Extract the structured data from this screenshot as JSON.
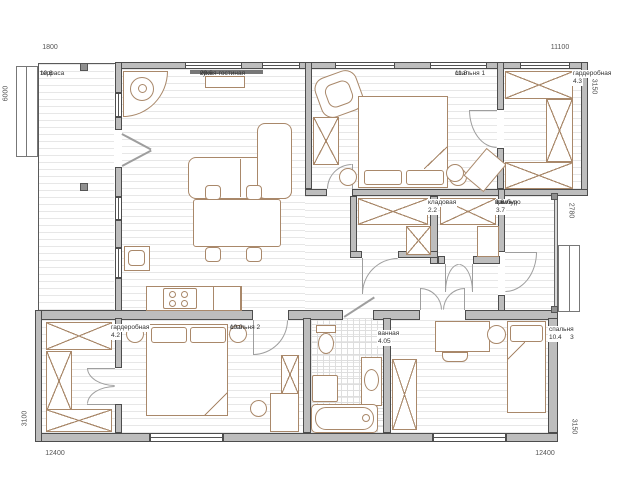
{
  "plan": {
    "title": "floor-plan",
    "rooms": {
      "terrace": {
        "name": "терраса",
        "area": "10.8"
      },
      "kitchen_living": {
        "name": "кухня-гостиная",
        "area": "29.6"
      },
      "bedroom1": {
        "name": "спальня 1",
        "area": "11.8"
      },
      "wardrobe1": {
        "name": "гардеробная",
        "area": "4.3"
      },
      "storage": {
        "name": "кладовая",
        "area": "2.2"
      },
      "vestibule": {
        "name": "тамбур",
        "area": "3.7"
      },
      "porch": {
        "name": "крыльцо",
        "area": "3.6"
      },
      "wardrobe2": {
        "name": "гардеробная",
        "area": "4.2"
      },
      "bedroom2": {
        "name": "спальня 2",
        "area": "10.9"
      },
      "bathroom": {
        "name": "ванная",
        "area": "4.05"
      },
      "bedroom3": {
        "name": "спальня 3",
        "area": "10.4"
      }
    },
    "dimensions": {
      "top_left": "1800",
      "top_right": "11100",
      "left_upper": "6000",
      "left_lower": "3100",
      "right_upper": "3150",
      "right_middle": "2780",
      "right_lower": "3150",
      "bottom_left": "12400",
      "bottom_right": "12400"
    },
    "colors": {
      "wall_fill": "#bdbdbd",
      "wall_edge": "#4d4d4d",
      "furniture_line": "#a9886a",
      "floor_line": "#e7e7e7",
      "room_text": "#333333",
      "dim_text": "#555555"
    }
  }
}
